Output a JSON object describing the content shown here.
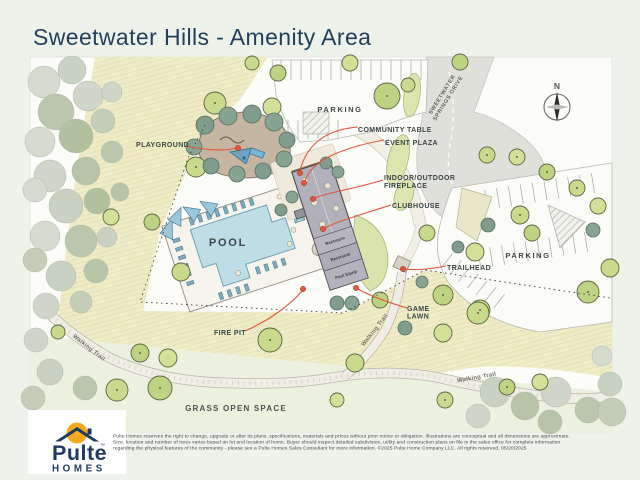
{
  "page": {
    "title": "Sweetwater Hills - Amenity Area"
  },
  "map": {
    "compass": {
      "north": "N"
    },
    "street": {
      "line1": "SWEETWATER",
      "line2": "SPRINGS DRIVE"
    },
    "labels": {
      "playground": "PLAYGROUND",
      "parking_top": "PARKING",
      "parking_right": "PARKING",
      "community_table": "COMMUNITY TABLE",
      "event_plaza": "EVENT PLAZA",
      "fireplace_1": "INDOOR/OUTDOOR",
      "fireplace_2": "FIREPLACE",
      "clubhouse": "CLUBHOUSE",
      "pool": "POOL",
      "trailhead": "TRAILHEAD",
      "game_lawn_1": "GAME",
      "game_lawn_2": "LAWN",
      "fire_pit": "FIRE PIT",
      "grass_open_space": "GRASS OPEN SPACE",
      "walking_trail_left": "Walking Trail",
      "walking_trail_mid": "Walking Trail",
      "walking_trail_right": "Walking Trail"
    },
    "rooms": {
      "restroom_1": "Restroom",
      "restroom_2": "Restroom",
      "pool_equip": "Pool Equip"
    }
  },
  "footer": {
    "logo": {
      "name": "Pulte",
      "sub": "HOMES",
      "tm": "™"
    },
    "disclaimer": {
      "line1": "Pulte Homes reserves the right to change, upgrade or alter its plans, specifications, materials and prices without prior notice or obligation. Illustrations are conceptual and all dimensions are approximate.",
      "line2": "Size, location and number of trees varies based on lot and location of home. Buyer should inspect detailed subdivision, utility and construction plans on file in the sales office for complete information",
      "line3": "regarding the physical features of the community - please see a Pulte Homes Sales Consultant for more information. ©2025 Pulte Home Company LLC. All rights reserved.  05/20/2025"
    }
  },
  "colors": {
    "page_bg": "#EDF3EB",
    "map_bg": "#FCFCF9",
    "title_navy": "#22405E",
    "brand_navy": "#1D3A5F",
    "logo_orange": "#F3A81D",
    "accent_leader_red": "#E2563D",
    "label_charcoal": "#3C4747",
    "lawn_hatch": "#EFEBC7",
    "tree_green": "#C9DA8C",
    "tree_teal": "#7F9C8D",
    "pool_water": "#BFDDE6",
    "building_gray": "#B2B0BB",
    "road_gray": "#E0E0DB"
  }
}
